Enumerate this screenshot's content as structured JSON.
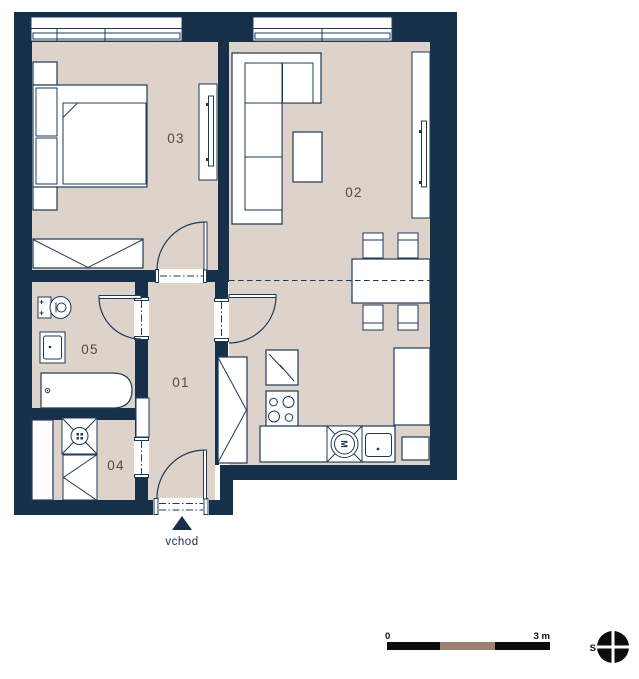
{
  "theme": {
    "wall": "#16304a",
    "floor": "#ddd3cb",
    "line": "#1e3a57",
    "room_label": "#5d4733",
    "scale_black": "#0d0d0d",
    "scale_brown": "#9c8071"
  },
  "rooms": {
    "hall": {
      "label": "01"
    },
    "living": {
      "label": "02"
    },
    "bedroom": {
      "label": "03"
    },
    "storage": {
      "label": "04"
    },
    "bathroom": {
      "label": "05"
    }
  },
  "entrance": {
    "label": "vchod"
  },
  "appliances": {
    "washing_machine_letter": "M"
  },
  "scale_bar": {
    "start_label": "0",
    "end_label": "3 m"
  },
  "compass": {
    "north_label": "S"
  }
}
